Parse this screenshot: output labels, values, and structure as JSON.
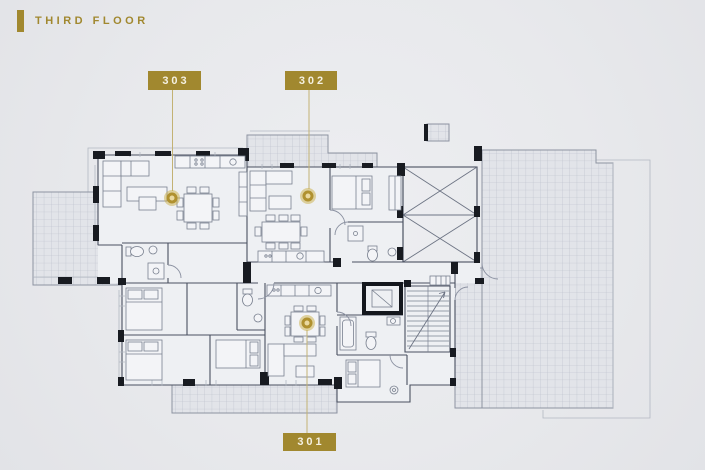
{
  "page": {
    "title": "THIRD FLOOR"
  },
  "apartments": [
    {
      "number": "303"
    },
    {
      "number": "302"
    },
    {
      "number": "301"
    }
  ],
  "colors": {
    "background": "#e8e9ec",
    "gold": "#a1882f",
    "gold_light": "#c3b274",
    "label_text": "#f5f1e2",
    "wall": "#4a5060",
    "wall_black": "#181b21",
    "tile_line": "#b9bec9",
    "tile_fill": "#e2e4e9",
    "room_fill": "#eef0f3",
    "furniture": "#79808f"
  }
}
